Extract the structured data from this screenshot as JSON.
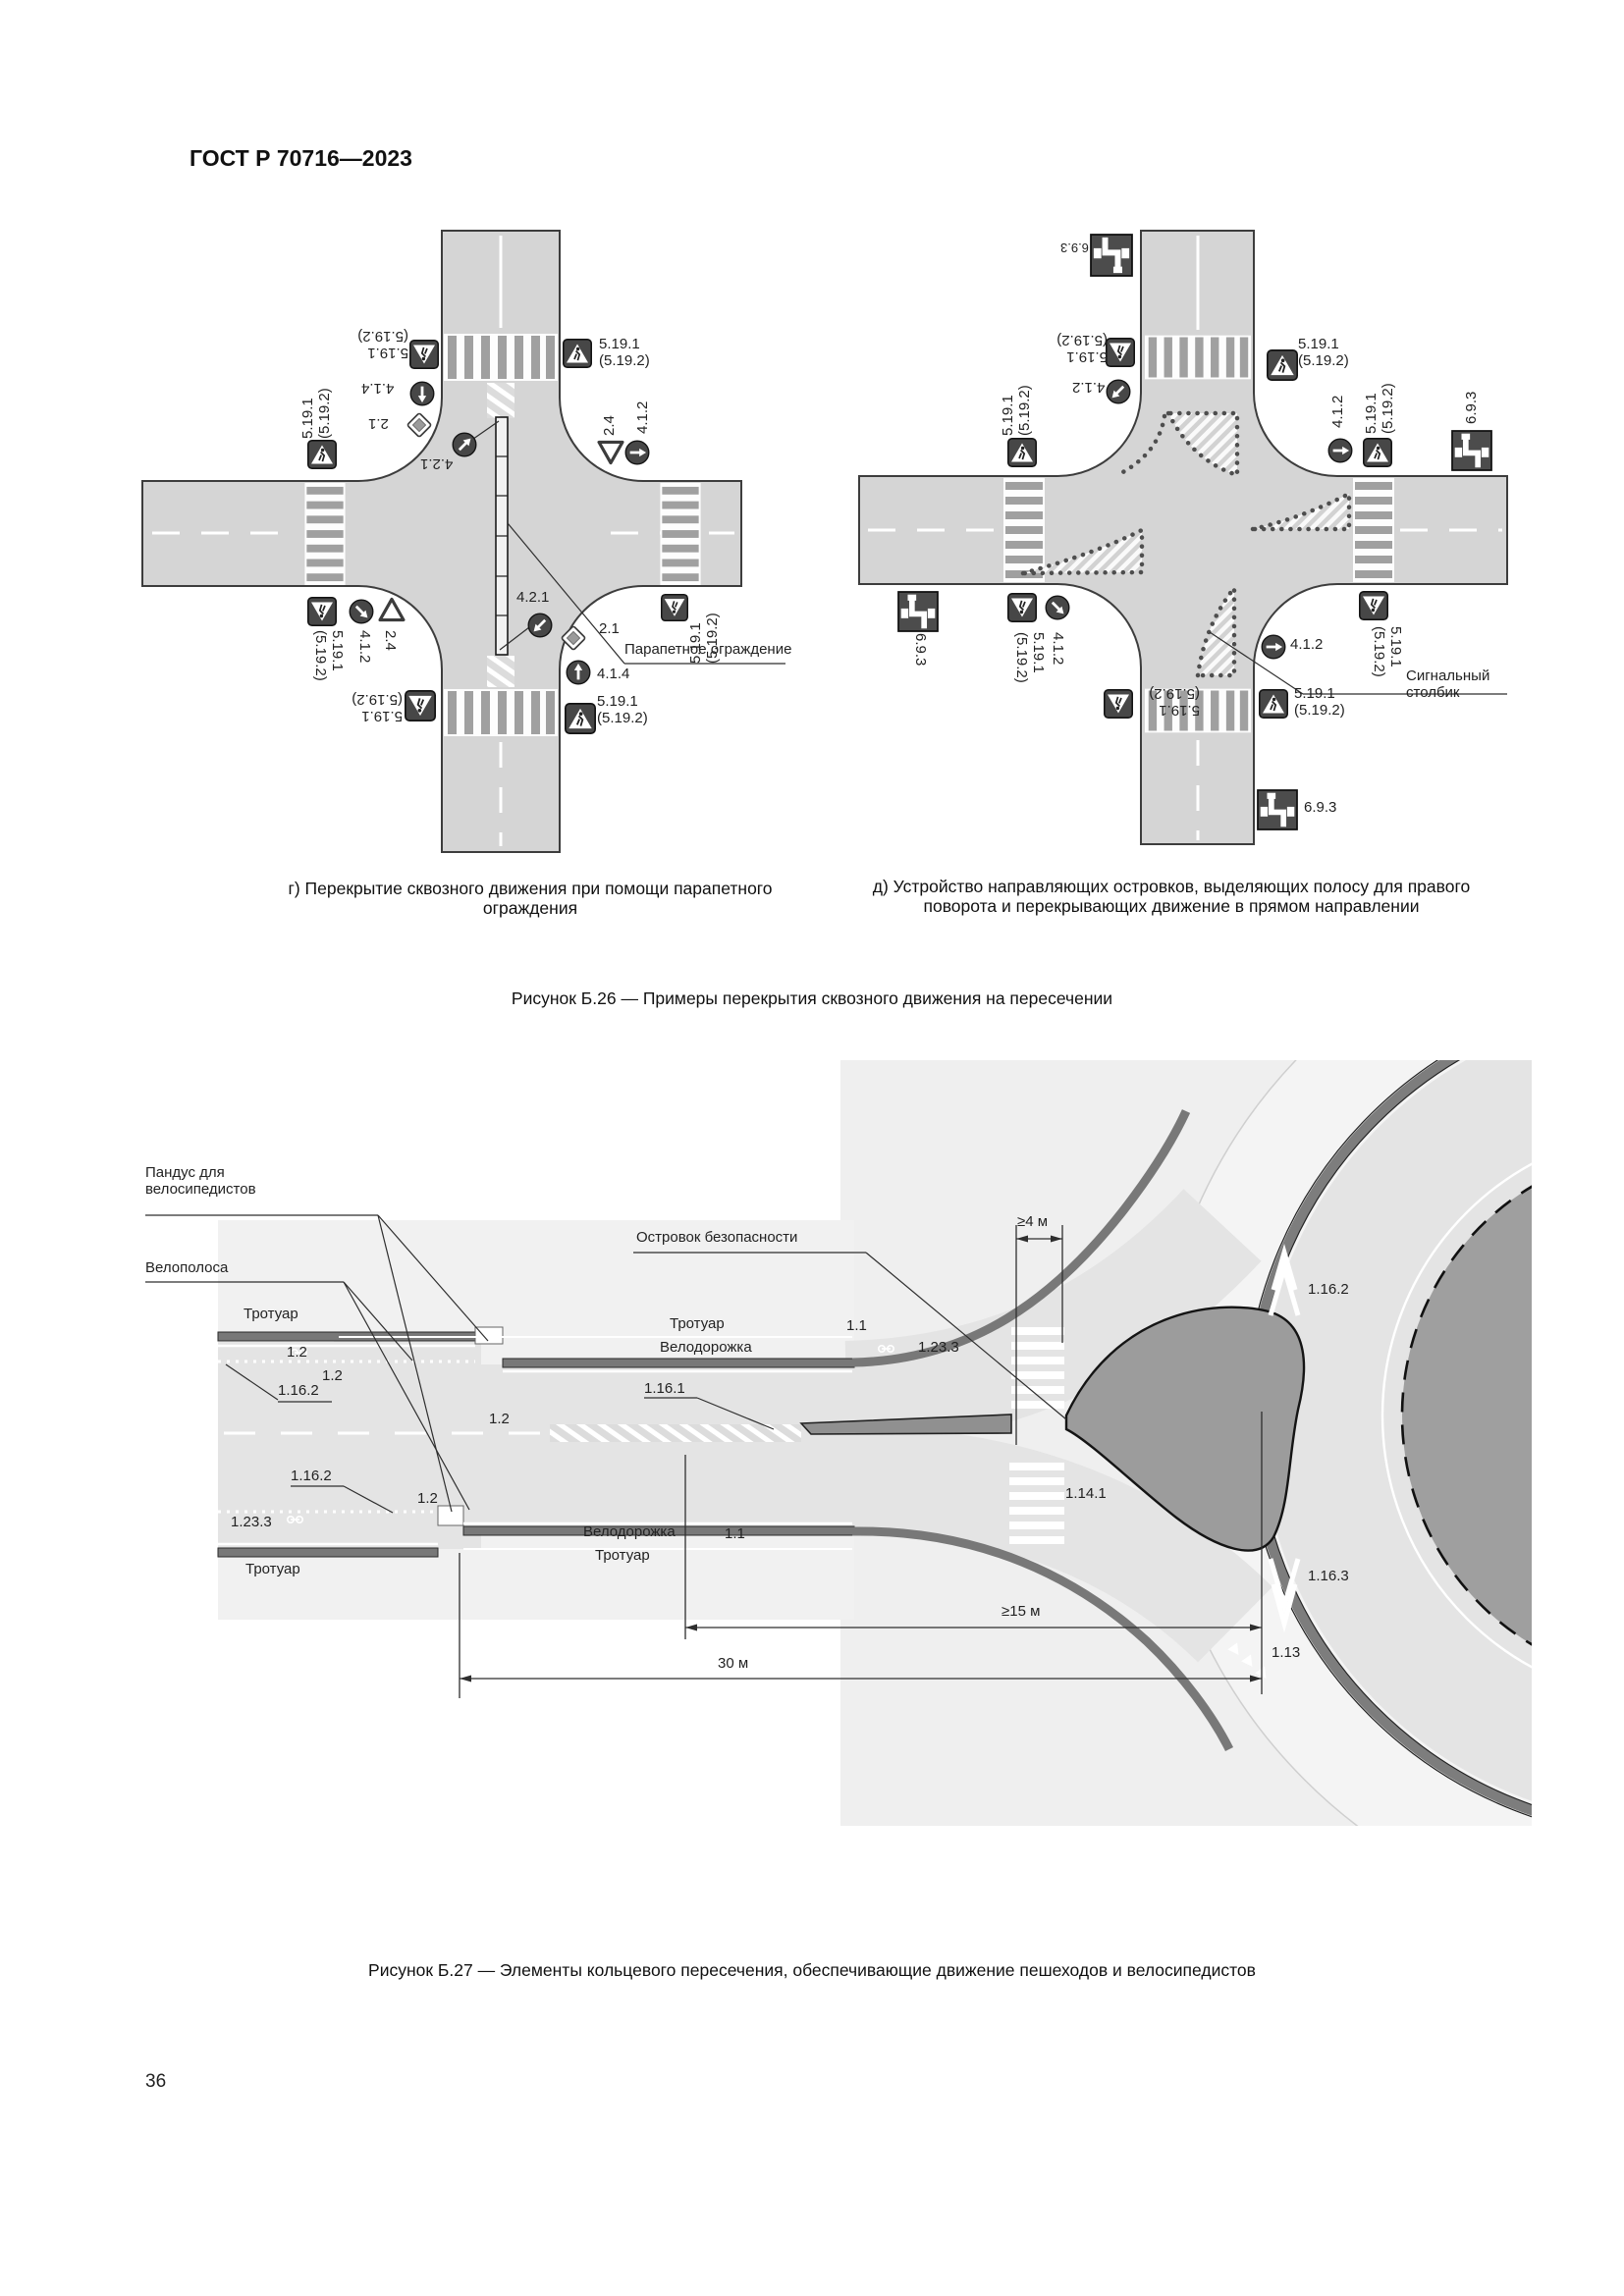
{
  "page": {
    "header": "ГОСТ Р 70716—2023",
    "number": "36"
  },
  "figure_b26": {
    "caption_g": "г) Перекрытие сквозного движения при помощи парапетного ограждения",
    "caption_d": "д) Устройство направляющих островков, выделяющих полосу для правого поворота и перекрывающих движение в прямом направлении",
    "caption": "Рисунок Б.26 — Примеры перекрытия сквозного движения на пересечении",
    "signs": {
      "combo": "5.19.1 (5.19.2)",
      "s21": "2.1",
      "s24": "2.4",
      "s412": "4.1.2",
      "s414": "4.1.4",
      "s421": "4.2.1",
      "s693": "6.9.3"
    },
    "left": {
      "parapet_label": "Парапетное ограждение"
    },
    "right": {
      "signal_post_label": "Сигнальный столбик"
    }
  },
  "figure_b27": {
    "caption": "Рисунок Б.27 — Элементы кольцевого пересечения, обеспечивающие движение пешеходов и велосипедистов",
    "labels": {
      "ramp": "Пандус для велосипедистов",
      "bike_lane": "Велополоса",
      "safety_island": "Островок безопасности",
      "sidewalk": "Тротуар",
      "bike_path": "Велодорожка"
    },
    "markings": {
      "m1_1": "1.1",
      "m1_2": "1.2",
      "m1_13": "1.13",
      "m1_14_1": "1.14.1",
      "m1_16_1": "1.16.1",
      "m1_16_2": "1.16.2",
      "m1_16_3": "1.16.3",
      "m1_23_3": "1.23.3"
    },
    "dimensions": {
      "d4": "≥4 м",
      "d15": "≥15 м",
      "d30": "30 м"
    }
  }
}
